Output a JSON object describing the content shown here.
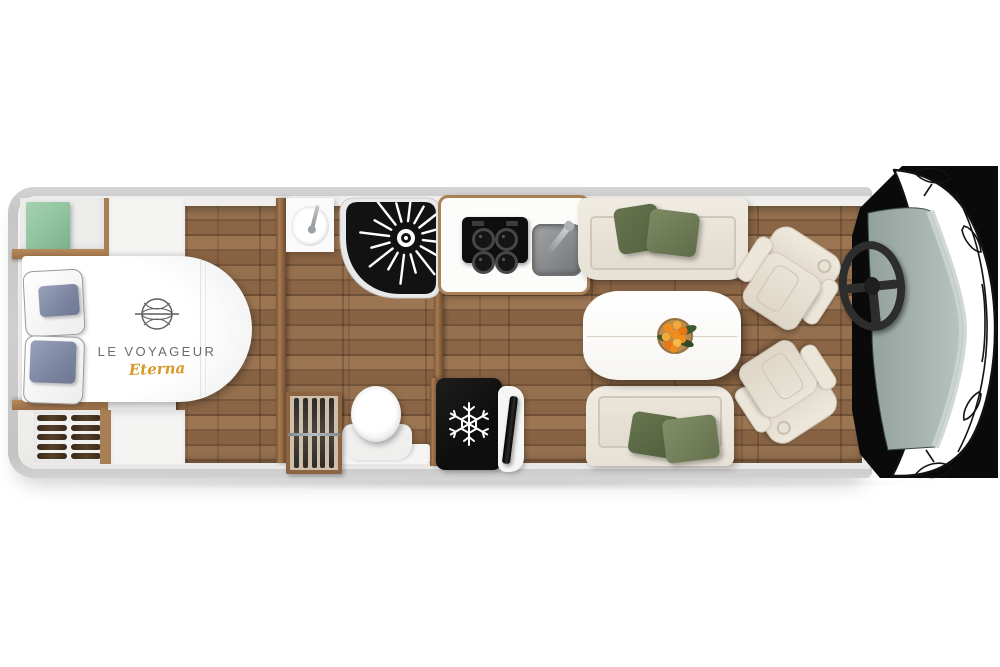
{
  "branding": {
    "name": "LE VOYAGEUR",
    "model": "Eterna",
    "name_color": "#6b6b6b",
    "model_color": "#d8992b"
  },
  "layout": {
    "type": "motorhome-floorplan-top-view",
    "zones": [
      {
        "name": "bedroom",
        "items": [
          "island-bed",
          "pillows",
          "green-storage-box",
          "overhead-wardrobe",
          "wood-shelves",
          "hanger-wardrobe",
          "bedside-cabinet"
        ]
      },
      {
        "name": "bathroom",
        "items": [
          "washbasin",
          "shower",
          "toilet",
          "hanging-wardrobe"
        ]
      },
      {
        "name": "kitchen",
        "items": [
          "worktop",
          "hob",
          "sink",
          "refrigerator",
          "tv-screen"
        ]
      },
      {
        "name": "lounge",
        "items": [
          "sofa-front",
          "sofa-rear",
          "dining-table",
          "flower-bowl",
          "swivel-seat-left",
          "swivel-seat-right"
        ]
      },
      {
        "name": "cab",
        "items": [
          "steering-wheel",
          "dashboard",
          "windscreen",
          "vehicle-front-outline",
          "side-mirrors"
        ]
      }
    ],
    "counts": {
      "hob_burners": 4,
      "shower_jets": 16,
      "bath_hanger_blades": 5,
      "bed_wardrobe_hanger_rows": 5
    }
  },
  "palette": {
    "background": "#ffffff",
    "body_shell": "#c9c9c8",
    "inner_wall": "#f0efed",
    "floor_wood": "#8b6749",
    "wood_trim": "#a87e54",
    "bed_linen": "#f8f8f8",
    "pillow_blue": "#7f89a4",
    "cabinet_green": "#94c6a2",
    "cushion_olive_dark": "#5e6a4b",
    "cushion_olive_light": "#76815e",
    "sofa_cream": "#ece7dd",
    "appliance_black": "#141414",
    "sink_grey": "#8e9093",
    "windscreen_glass": "#a3b0ab",
    "flowers_orange": "#ef9428"
  }
}
